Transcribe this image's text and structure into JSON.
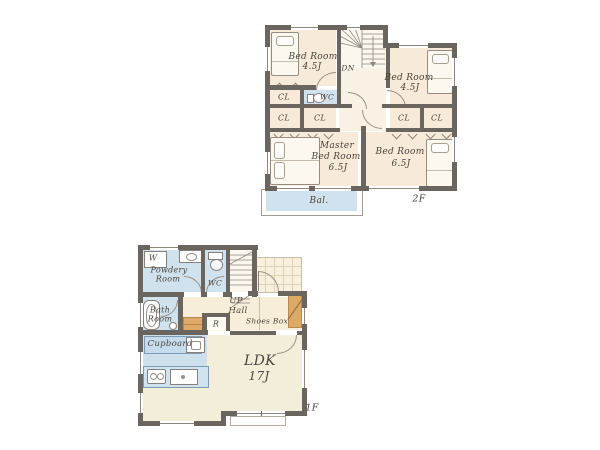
{
  "colors": {
    "wall": "#6b655f",
    "room_cream": "#f8ead8",
    "ldk_cream": "#f2eeda",
    "water_blue": "#cfe2ee",
    "kitchen_blue": "#cde0ec",
    "wood_tan": "#dca96b",
    "text": "#4a443c"
  },
  "floor_2f": {
    "floor_label": "2F",
    "bedroom_top_left": {
      "name": "Bed Room",
      "size": "4.5J"
    },
    "bedroom_top_right": {
      "name": "Bed Room",
      "size": "4.5J"
    },
    "master_bedroom": {
      "line1": "Master",
      "line2": "Bed Room",
      "size": "6.5J"
    },
    "bedroom_bottom_right": {
      "name": "Bed Room",
      "size": "6.5J"
    },
    "closets": [
      "CL",
      "CL",
      "CL",
      "CL",
      "CL",
      "CL"
    ],
    "wc_label": "WC",
    "stairs_label": "DN",
    "balcony_label": "Bal."
  },
  "floor_1f": {
    "floor_label": "1F",
    "washer_label": "W",
    "powder_room": {
      "line1": "Powdery",
      "line2": "Room"
    },
    "wc_label": "WC",
    "hall": {
      "line1": "UP",
      "line2": "Hall"
    },
    "bath_room": {
      "line1": "Bath",
      "line2": "Room"
    },
    "refrigerator_label": "R",
    "shoes_box_label": "Shoes Box",
    "cupboard_label": "Cupboard",
    "ldk": {
      "name": "LDK",
      "size": "17J"
    }
  }
}
